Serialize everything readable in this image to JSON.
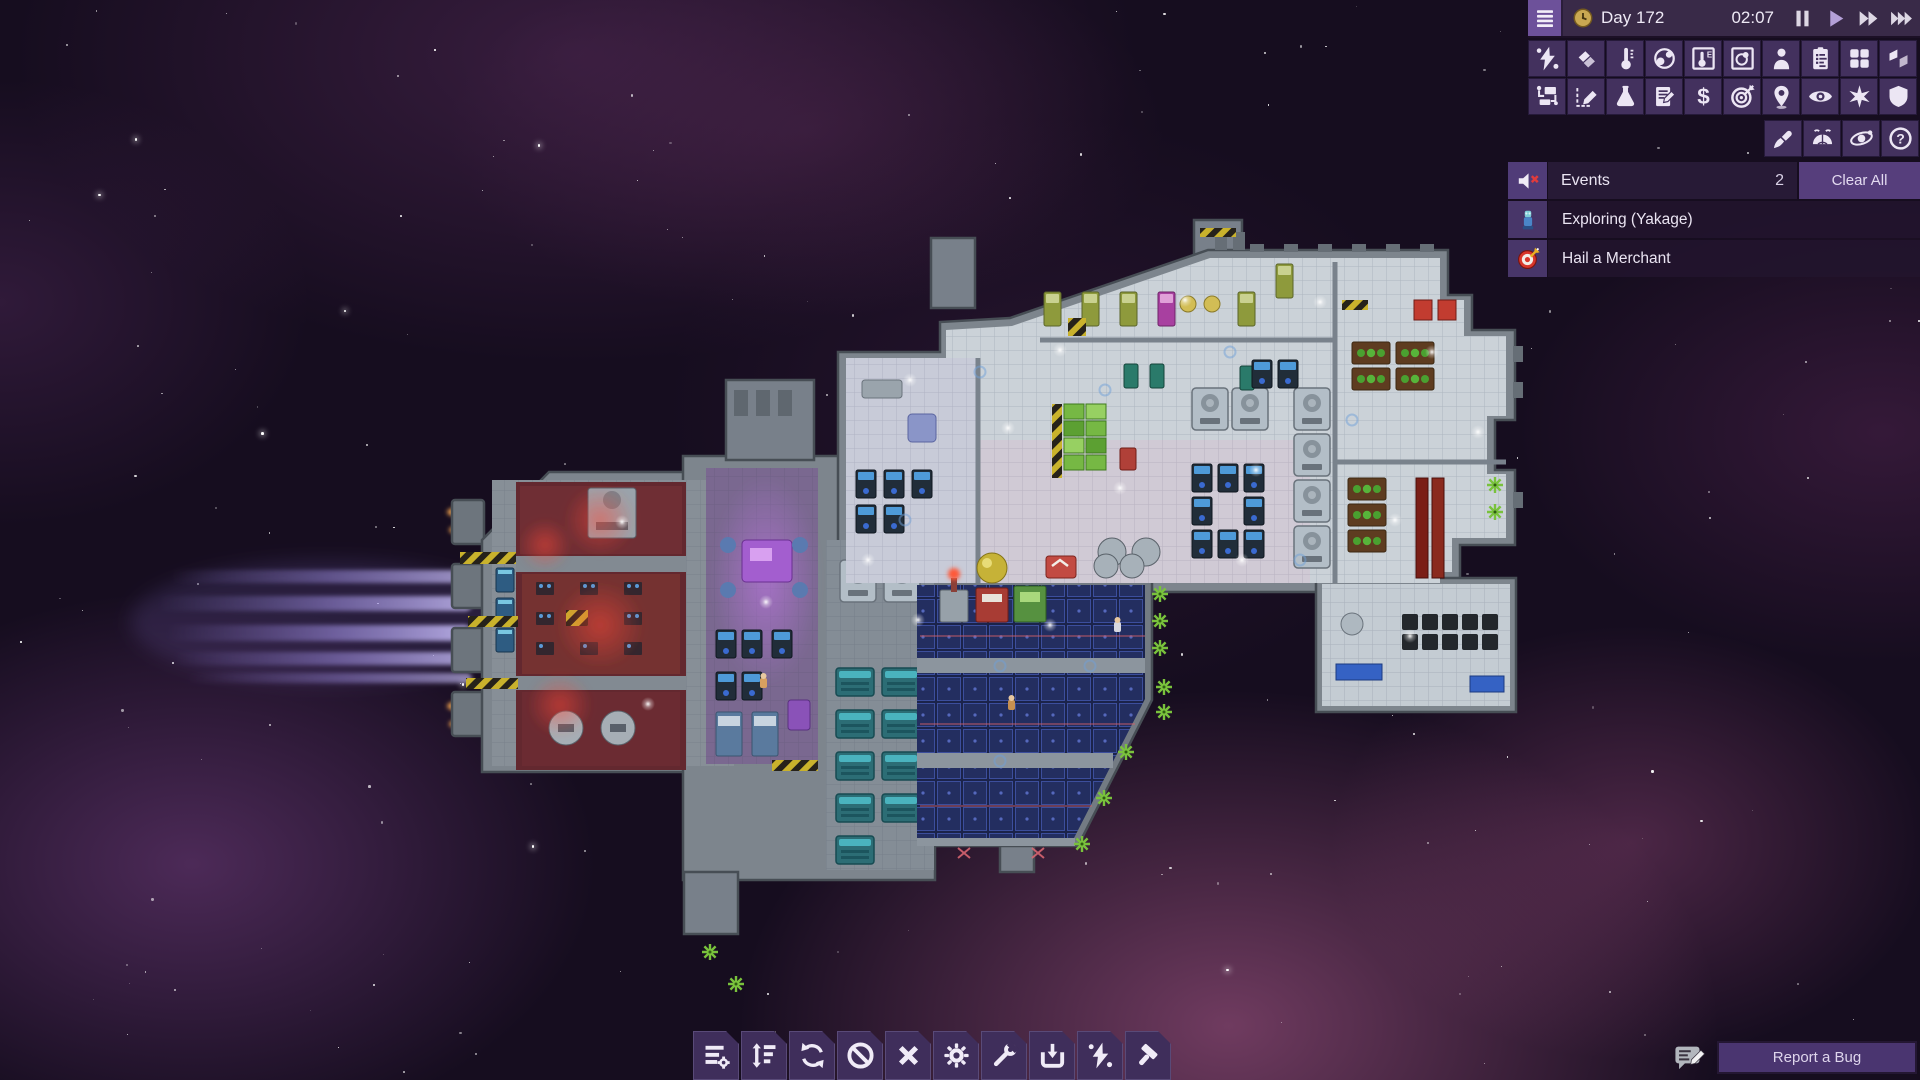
{
  "topbar": {
    "day_label": "Day 172",
    "time_label": "02:07",
    "active_speed": "play",
    "controls": [
      "pause",
      "play",
      "fast-forward",
      "fastest-forward"
    ]
  },
  "view_toolbars": {
    "row1": [
      "power-view",
      "hull-layers-view",
      "temperature-view",
      "gas-view",
      "temperature-overlay",
      "gas-overlay",
      "crew-view",
      "conditions-view",
      "rooms-view",
      "floors-view"
    ],
    "row2": [
      "logistics-view",
      "draw-plan",
      "research",
      "ship-log",
      "trade",
      "missions",
      "navigation",
      "observation",
      "system-view",
      "shields"
    ],
    "row3": [
      "customize",
      "planet-view",
      "orbit-view",
      "help"
    ]
  },
  "events_panel": {
    "title": "Events",
    "count": "2",
    "clear_all_label": "Clear All",
    "mute_icon": "muted-speaker-icon",
    "items": [
      {
        "icon": "exploration-pod-icon",
        "label": "Exploring (Yakage)"
      },
      {
        "icon": "mission-target-icon",
        "label": "Hail a Merchant"
      }
    ]
  },
  "bottom_toolbar": [
    "build-menu",
    "priorities",
    "rotate",
    "forbid",
    "cancel",
    "settings",
    "repair",
    "salvage",
    "power",
    "deconstruct"
  ],
  "report_bug": {
    "label": "Report a Bug"
  },
  "colors": {
    "ui_panel": "#392a48",
    "ui_tile": "#43315e",
    "ui_accent": "#6d519a",
    "ui_active_speed": "#b4a0d8",
    "ui_text": "#eee9f5",
    "event_row": "#22152d",
    "clear_all_bg": "#563e7c",
    "space_base": "#160d1f",
    "engine_beam": "#a393e8",
    "hull_gray": "#7d858d",
    "red_room": "#6f2e34",
    "hangar_blue": "#1b234a",
    "green_marker": "#79c23c"
  }
}
